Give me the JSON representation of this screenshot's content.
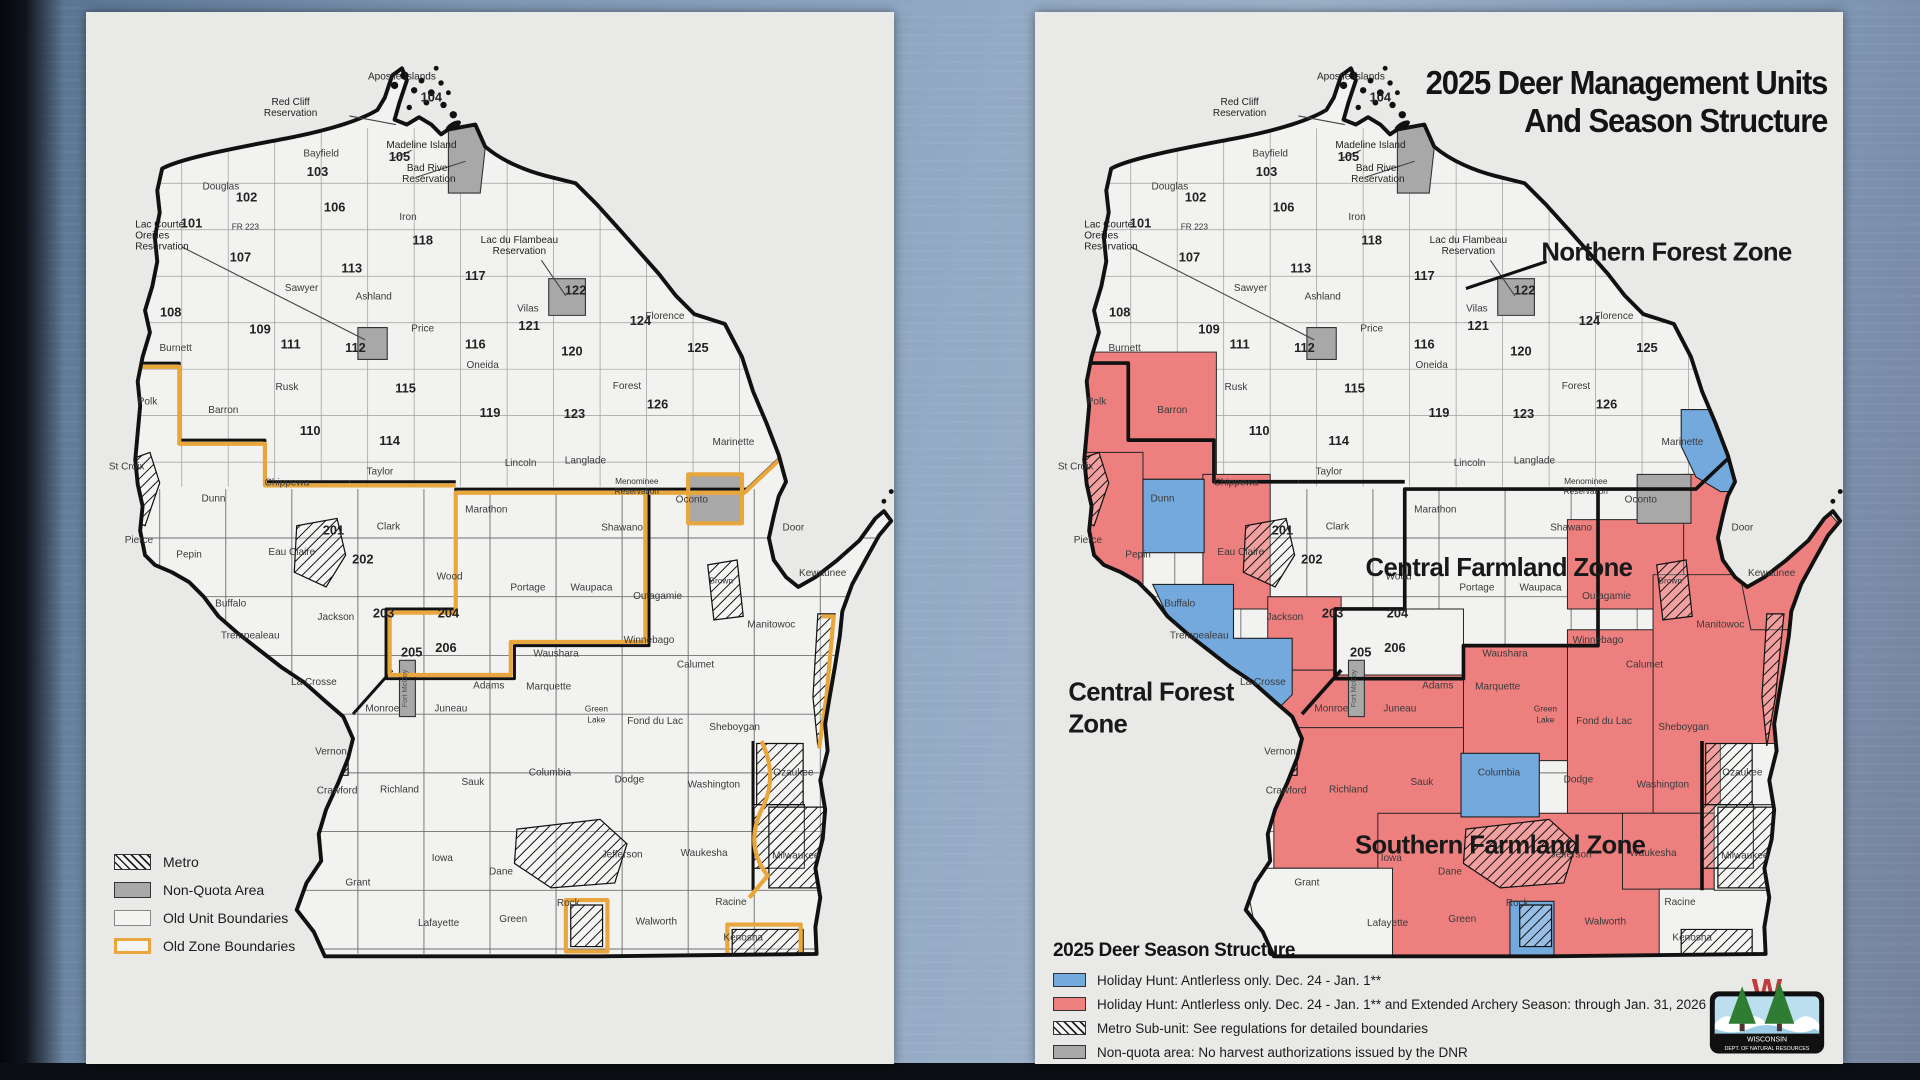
{
  "colors": {
    "holiday_blue": "#74a9dd",
    "holiday_red": "#ee7f7f",
    "non_quota_gray": "#a8a8a8",
    "old_zone_orange": "#e8a63c",
    "panel_bg": "#e9e9e7",
    "map_fill": "#f2f2f0",
    "outline_black": "#111111"
  },
  "left_map": {
    "name": "Old deer management units map",
    "legend": {
      "items": [
        {
          "swatch": "metro",
          "label": "Metro"
        },
        {
          "swatch": "nonquota",
          "label": "Non-Quota Area"
        },
        {
          "swatch": "oldunit",
          "label": "Old Unit Boundaries"
        },
        {
          "swatch": "oldzone",
          "label": "Old Zone Boundaries"
        }
      ]
    }
  },
  "right_map": {
    "title_line1": "2025 Deer Management Units",
    "title_line2": "And Season Structure",
    "zones": [
      {
        "label": "Northern Forest Zone",
        "x": 516,
        "y": 203,
        "anchor": "middle"
      },
      {
        "label": "Central Farmland Zone",
        "x": 379,
        "y": 461,
        "anchor": "middle"
      },
      {
        "label": "Central Forest",
        "x": 27,
        "y": 563,
        "anchor": "start"
      },
      {
        "label": "Zone",
        "x": 27,
        "y": 589,
        "anchor": "start"
      },
      {
        "label": "Southern Farmland Zone",
        "x": 380,
        "y": 688,
        "anchor": "middle"
      }
    ],
    "legend": {
      "title": "2025 Deer Season Structure",
      "items": [
        {
          "swatch": "blue",
          "label": "Holiday Hunt: Antlerless only. Dec. 24 - Jan. 1**"
        },
        {
          "swatch": "red",
          "label": "Holiday Hunt: Antlerless only. Dec. 24 - Jan. 1** and Extended Archery Season: through Jan. 31, 2026"
        },
        {
          "swatch": "hatch",
          "label": "Metro Sub-unit: See regulations for detailed boundaries"
        },
        {
          "swatch": "gray",
          "label": "Non-quota area: No harvest authorizations issued by the DNR"
        }
      ]
    },
    "logo": {
      "line1": "WISCONSIN",
      "line2": "DEPT. OF NATURAL RESOURCES"
    }
  },
  "map_labels": [
    {
      "t": "Apostle Islands",
      "x": 258,
      "y": 55,
      "k": "o"
    },
    {
      "t": "104",
      "x": 282,
      "y": 73,
      "k": "n"
    },
    {
      "t": "Red Cliff",
      "x": 167,
      "y": 76,
      "k": "o"
    },
    {
      "t": "Reservation",
      "x": 167,
      "y": 85,
      "k": "o"
    },
    {
      "t": "Madeline Island",
      "x": 274,
      "y": 111,
      "k": "o"
    },
    {
      "t": "105",
      "x": 256,
      "y": 122,
      "k": "n"
    },
    {
      "t": "Bayfield",
      "x": 192,
      "y": 118,
      "k": "c"
    },
    {
      "t": "103",
      "x": 189,
      "y": 134,
      "k": "n"
    },
    {
      "t": "Bad River",
      "x": 280,
      "y": 130,
      "k": "o"
    },
    {
      "t": "Reservation",
      "x": 280,
      "y": 139,
      "k": "o"
    },
    {
      "t": "Douglas",
      "x": 110,
      "y": 145,
      "k": "c"
    },
    {
      "t": "102",
      "x": 131,
      "y": 155,
      "k": "n"
    },
    {
      "t": "106",
      "x": 203,
      "y": 163,
      "k": "n"
    },
    {
      "t": "Iron",
      "x": 263,
      "y": 170,
      "k": "c"
    },
    {
      "t": "118",
      "x": 275,
      "y": 190,
      "k": "n"
    },
    {
      "t": "Lac Courte",
      "x": 40,
      "y": 176,
      "k": "o"
    },
    {
      "t": "Oreilles",
      "x": 40,
      "y": 185,
      "k": "o"
    },
    {
      "t": "Reservation",
      "x": 40,
      "y": 194,
      "k": "o"
    },
    {
      "t": "101",
      "x": 86,
      "y": 176,
      "k": "n"
    },
    {
      "t": "107",
      "x": 126,
      "y": 204,
      "k": "n"
    },
    {
      "t": "Lac du Flambeau",
      "x": 354,
      "y": 189,
      "k": "o"
    },
    {
      "t": "Reservation",
      "x": 354,
      "y": 198,
      "k": "o"
    },
    {
      "t": "117",
      "x": 318,
      "y": 219,
      "k": "n"
    },
    {
      "t": "Sawyer",
      "x": 176,
      "y": 228,
      "k": "c"
    },
    {
      "t": "Ashland",
      "x": 235,
      "y": 235,
      "k": "c"
    },
    {
      "t": "113",
      "x": 217,
      "y": 213,
      "k": "n"
    },
    {
      "t": "122",
      "x": 400,
      "y": 231,
      "k": "n"
    },
    {
      "t": "Vilas",
      "x": 361,
      "y": 245,
      "k": "c"
    },
    {
      "t": "121",
      "x": 362,
      "y": 260,
      "k": "n"
    },
    {
      "t": "124",
      "x": 453,
      "y": 256,
      "k": "n"
    },
    {
      "t": "Florence",
      "x": 473,
      "y": 251,
      "k": "c"
    },
    {
      "t": "125",
      "x": 500,
      "y": 278,
      "k": "n"
    },
    {
      "t": "Price",
      "x": 275,
      "y": 261,
      "k": "c"
    },
    {
      "t": "116",
      "x": 318,
      "y": 275,
      "k": "n"
    },
    {
      "t": "Oneida",
      "x": 324,
      "y": 291,
      "k": "c"
    },
    {
      "t": "120",
      "x": 397,
      "y": 281,
      "k": "n"
    },
    {
      "t": "108",
      "x": 69,
      "y": 249,
      "k": "n"
    },
    {
      "t": "Burnett",
      "x": 73,
      "y": 277,
      "k": "c"
    },
    {
      "t": "109",
      "x": 142,
      "y": 263,
      "k": "n"
    },
    {
      "t": "111",
      "x": 167,
      "y": 275,
      "k": "n"
    },
    {
      "t": "112",
      "x": 220,
      "y": 278,
      "k": "n"
    },
    {
      "t": "115",
      "x": 261,
      "y": 311,
      "k": "n"
    },
    {
      "t": "Forest",
      "x": 442,
      "y": 308,
      "k": "c"
    },
    {
      "t": "126",
      "x": 467,
      "y": 324,
      "k": "n"
    },
    {
      "t": "123",
      "x": 399,
      "y": 332,
      "k": "n"
    },
    {
      "t": "Polk",
      "x": 50,
      "y": 321,
      "k": "c"
    },
    {
      "t": "Barron",
      "x": 112,
      "y": 328,
      "k": "c"
    },
    {
      "t": "Rusk",
      "x": 164,
      "y": 309,
      "k": "c"
    },
    {
      "t": "110",
      "x": 183,
      "y": 346,
      "k": "n"
    },
    {
      "t": "114",
      "x": 248,
      "y": 354,
      "k": "n"
    },
    {
      "t": "119",
      "x": 330,
      "y": 331,
      "k": "n"
    },
    {
      "t": "Marinette",
      "x": 529,
      "y": 354,
      "k": "c"
    },
    {
      "t": "Lincoln",
      "x": 355,
      "y": 371,
      "k": "c"
    },
    {
      "t": "Langlade",
      "x": 408,
      "y": 369,
      "k": "c"
    },
    {
      "t": "Taylor",
      "x": 240,
      "y": 378,
      "k": "c"
    },
    {
      "t": "Menominee",
      "x": 450,
      "y": 386,
      "k": "t"
    },
    {
      "t": "Reservation",
      "x": 450,
      "y": 394,
      "k": "t"
    },
    {
      "t": "Oconto",
      "x": 495,
      "y": 401,
      "k": "c"
    },
    {
      "t": "St Croix",
      "x": 33,
      "y": 374,
      "k": "c"
    },
    {
      "t": "Dunn",
      "x": 104,
      "y": 400,
      "k": "c"
    },
    {
      "t": "Chippewa",
      "x": 164,
      "y": 387,
      "k": "c"
    },
    {
      "t": "201",
      "x": 202,
      "y": 427,
      "k": "n"
    },
    {
      "t": "Clark",
      "x": 247,
      "y": 423,
      "k": "c"
    },
    {
      "t": "Marathon",
      "x": 327,
      "y": 409,
      "k": "c"
    },
    {
      "t": "Shawano",
      "x": 438,
      "y": 424,
      "k": "c"
    },
    {
      "t": "Door",
      "x": 578,
      "y": 424,
      "k": "c"
    },
    {
      "t": "Pierce",
      "x": 43,
      "y": 434,
      "k": "c"
    },
    {
      "t": "Pepin",
      "x": 84,
      "y": 446,
      "k": "c"
    },
    {
      "t": "Eau Claire",
      "x": 168,
      "y": 444,
      "k": "c"
    },
    {
      "t": "202",
      "x": 226,
      "y": 451,
      "k": "n"
    },
    {
      "t": "Kewaunee",
      "x": 602,
      "y": 461,
      "k": "c"
    },
    {
      "t": "Wood",
      "x": 297,
      "y": 464,
      "k": "c"
    },
    {
      "t": "Portage",
      "x": 361,
      "y": 473,
      "k": "c"
    },
    {
      "t": "Waupaca",
      "x": 413,
      "y": 473,
      "k": "c"
    },
    {
      "t": "Outagamie",
      "x": 467,
      "y": 480,
      "k": "c"
    },
    {
      "t": "Brown",
      "x": 519,
      "y": 467,
      "k": "t"
    },
    {
      "t": "Buffalo",
      "x": 118,
      "y": 486,
      "k": "c"
    },
    {
      "t": "Jackson",
      "x": 204,
      "y": 497,
      "k": "c"
    },
    {
      "t": "203",
      "x": 243,
      "y": 495,
      "k": "n"
    },
    {
      "t": "Trempealeau",
      "x": 134,
      "y": 512,
      "k": "c"
    },
    {
      "t": "204",
      "x": 296,
      "y": 495,
      "k": "n"
    },
    {
      "t": "206",
      "x": 294,
      "y": 523,
      "k": "n"
    },
    {
      "t": "205",
      "x": 266,
      "y": 527,
      "k": "n"
    },
    {
      "t": "Winnebago",
      "x": 460,
      "y": 516,
      "k": "c"
    },
    {
      "t": "Manitowoc",
      "x": 560,
      "y": 503,
      "k": "c"
    },
    {
      "t": "Waushara",
      "x": 384,
      "y": 527,
      "k": "c"
    },
    {
      "t": "Calumet",
      "x": 498,
      "y": 536,
      "k": "c"
    },
    {
      "t": "La Crosse",
      "x": 186,
      "y": 550,
      "k": "c"
    },
    {
      "t": "Marquette",
      "x": 378,
      "y": 554,
      "k": "c"
    },
    {
      "t": "Adams",
      "x": 329,
      "y": 553,
      "k": "c"
    },
    {
      "t": "Monroe",
      "x": 242,
      "y": 572,
      "k": "c"
    },
    {
      "t": "Juneau",
      "x": 298,
      "y": 572,
      "k": "c"
    },
    {
      "t": "Green",
      "x": 417,
      "y": 572,
      "k": "t"
    },
    {
      "t": "Lake",
      "x": 417,
      "y": 581,
      "k": "t"
    },
    {
      "t": "Fond du Lac",
      "x": 465,
      "y": 582,
      "k": "c"
    },
    {
      "t": "Sheboygan",
      "x": 530,
      "y": 587,
      "k": "c"
    },
    {
      "t": "Vernon",
      "x": 200,
      "y": 607,
      "k": "c"
    },
    {
      "t": "Columbia",
      "x": 379,
      "y": 624,
      "k": "c"
    },
    {
      "t": "Sauk",
      "x": 316,
      "y": 632,
      "k": "c"
    },
    {
      "t": "Dodge",
      "x": 444,
      "y": 630,
      "k": "c"
    },
    {
      "t": "Ozaukee",
      "x": 578,
      "y": 624,
      "k": "c"
    },
    {
      "t": "Washington",
      "x": 513,
      "y": 634,
      "k": "c"
    },
    {
      "t": "Crawford",
      "x": 205,
      "y": 639,
      "k": "c"
    },
    {
      "t": "Richland",
      "x": 256,
      "y": 638,
      "k": "c"
    },
    {
      "t": "Milwaukee",
      "x": 580,
      "y": 692,
      "k": "c"
    },
    {
      "t": "Iowa",
      "x": 291,
      "y": 694,
      "k": "c"
    },
    {
      "t": "Dane",
      "x": 339,
      "y": 705,
      "k": "c"
    },
    {
      "t": "Jefferson",
      "x": 438,
      "y": 691,
      "k": "c"
    },
    {
      "t": "Waukesha",
      "x": 505,
      "y": 690,
      "k": "c"
    },
    {
      "t": "Grant",
      "x": 222,
      "y": 714,
      "k": "c"
    },
    {
      "t": "Lafayette",
      "x": 288,
      "y": 747,
      "k": "c"
    },
    {
      "t": "Green",
      "x": 349,
      "y": 744,
      "k": "c"
    },
    {
      "t": "Rock",
      "x": 394,
      "y": 731,
      "k": "c"
    },
    {
      "t": "Walworth",
      "x": 466,
      "y": 746,
      "k": "c"
    },
    {
      "t": "Racine",
      "x": 527,
      "y": 730,
      "k": "c"
    },
    {
      "t": "Kenosha",
      "x": 537,
      "y": 759,
      "k": "c"
    },
    {
      "t": "FR 223",
      "x": 130,
      "y": 178,
      "k": "t"
    },
    {
      "t": "Fort McCoy",
      "x": 262,
      "y": 553,
      "k": "v"
    }
  ]
}
